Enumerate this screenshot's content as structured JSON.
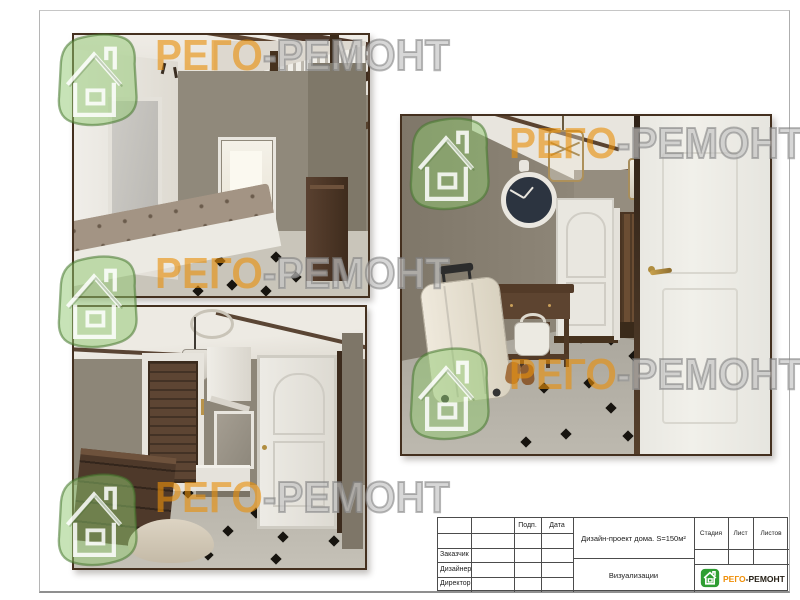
{
  "watermark": {
    "brand_orange": "РЕГО",
    "brand_gray": "-РЕМОНТ"
  },
  "title_block": {
    "cols": {
      "signature": "Подп.",
      "date": "Дата"
    },
    "roles": [
      "Заказчик",
      "Дизайнер",
      "Директор"
    ],
    "project_title": "Дизайн-проект дома. S=150м²",
    "sheet_name": "Визуализации",
    "stage": "Стадия",
    "sheet": "Лист",
    "sheets": "Листов",
    "brand_orange": "РЕГО",
    "brand_dark": "-РЕМОНТ"
  }
}
